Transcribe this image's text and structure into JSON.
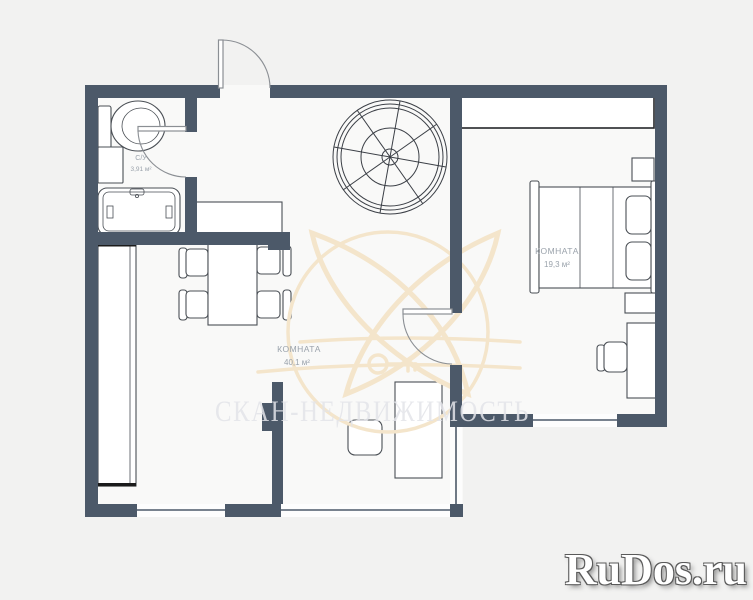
{
  "colors": {
    "background": "#f2f2f1",
    "floor": "#f9f9f8",
    "wall": "#4c5969",
    "furniture_stroke": "#4a4f55",
    "door_stroke": "#8b8f94",
    "label": "#9aa2ab",
    "watermark_text": "#e3e4e9",
    "watermark_graphic": "#f4e5cb",
    "logo_text": "#ffffff",
    "logo_outline": "#5a5a5a"
  },
  "labels": {
    "bathroom": {
      "name": "С/У",
      "area": "3,91 м²"
    },
    "living_room": {
      "name": "КОМНАТА",
      "area": "40,1 м²"
    },
    "bedroom": {
      "name": "КОМНАТА",
      "area": "19,3 м²"
    }
  },
  "watermark": {
    "text": "СКАН-НЕДВИЖИМОСТЬ"
  },
  "logo": {
    "text": "RuDos.ru"
  },
  "furniture": [
    "toilet",
    "bathroom-sink",
    "bathtub",
    "hallway-cabinet",
    "dining-table",
    "dining-chairs",
    "left-wardrobe",
    "spiral-staircase",
    "coffee-table",
    "tv-stand",
    "bedroom-wardrobe",
    "double-bed",
    "pillows",
    "nightstands",
    "desk",
    "desk-chair"
  ]
}
